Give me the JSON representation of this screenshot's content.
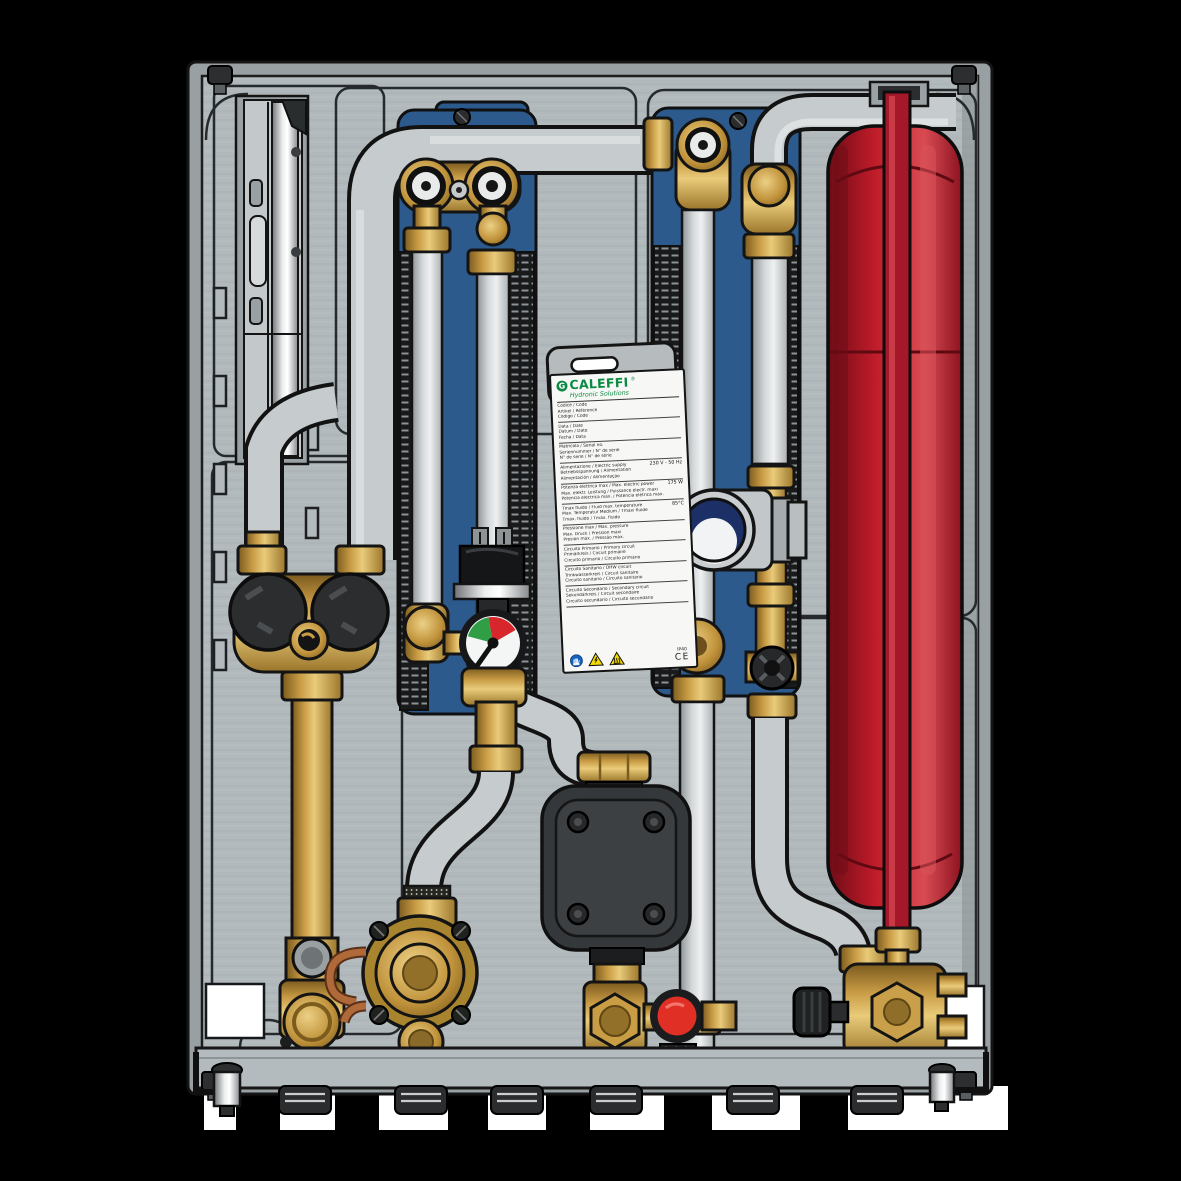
{
  "scene": {
    "background_color": "#000000",
    "description_fields_present": false
  },
  "label": {
    "brand": "CALEFFI",
    "registered_mark": "®",
    "logo_icon": "caleffi-ring-logo",
    "tagline": "Hydronic Solutions",
    "sections": [
      {
        "lines": [
          "Codice / Code",
          "Artikel / Référence",
          "Código / Code"
        ],
        "value": ""
      },
      {
        "lines": [
          "Data / Date",
          "Datum / Date",
          "Fecha / Data"
        ],
        "value": ""
      },
      {
        "lines": [
          "Matricola / Serial no.",
          "Seriennummer / N° de série",
          "N° de serie / N° de série"
        ],
        "value": ""
      },
      {
        "lines": [
          "Alimentazione / Electric supply",
          "Betriebsspannung / Alimentation",
          "Alimentación / Alimentação"
        ],
        "value": "230 V - 50 Hz"
      },
      {
        "lines": [
          "Potenza elettrica max / Max. electric power",
          "Max. elektr. Leistung / Puissance électr. maxi",
          "Potencia eléctrica máx. / Potência elétrica máx."
        ],
        "value": "175 W"
      },
      {
        "lines": [
          "Tmax fluido / Fluid max. temperature",
          "Max. Temperatur Medium / Tmaxi fluide",
          "Tmáx. fluido / Tmáx. fluido"
        ],
        "value": "85°C"
      },
      {
        "lines": [
          "Pressione max / Max. pressure",
          "Max. Druck / Pression maxi",
          "Presión máx. / Pressão máx."
        ],
        "value": ""
      },
      {
        "lines": [
          "Circuito Primario / Primary circuit",
          "Primärkreis / Circuit primaire",
          "Circuito primario / Circuito primário"
        ],
        "value": ""
      },
      {
        "lines": [
          "Circuito Sanitario / DHW circuit",
          "Trinkwasserkreis / Circuit sanitaire",
          "Circuito sanitario / Circuito sanitário"
        ],
        "value": ""
      },
      {
        "lines": [
          "Circuito Secondario / Secondary circuit",
          "Sekundärkreis / Circuit secondaire",
          "Circuito secundario / Circuito secundário"
        ],
        "value": ""
      }
    ],
    "pictograms": [
      "wear-gloves-icon",
      "electric-hazard-icon",
      "hot-surface-icon"
    ],
    "ip_rating": "IP40",
    "ce_mark": "CE"
  },
  "components": {
    "left_meter_module": "heat-meter-bracket",
    "heat_exchangers": [
      "primary-plate-heat-exchanger",
      "dhw-plate-heat-exchanger"
    ],
    "expansion_vessel": "red-expansion-vessel",
    "pump": "circulation-pump",
    "gauge": "differential-pressure-gauge",
    "thermostatic_head": "dhw-temperature-control-head",
    "valves": [
      "dual-ball-valve-black-caps",
      "diaphragm-pressure-controller",
      "fill-valve-red-knob",
      "zone-valve-black-lever"
    ],
    "bottom_connections_count": 6
  },
  "gauge": {
    "green_sector": "#2f9e44",
    "red_sector": "#d7262c",
    "face": "#f4f5f5"
  },
  "colors": {
    "hx_blue": "#2d5a8c",
    "vessel_red": "#c01c2a",
    "vessel_pipe_red": "#a5182a",
    "brand_green": "#0b8a44",
    "knob_red": "#e03026",
    "brass": "#c89b44",
    "pipe_grey": "#c6cbcd",
    "panel_grey": "#b1b9bc",
    "pump_black": "#3c4043",
    "warn_yellow": "#f2d900",
    "glove_blue": "#1565c0",
    "background": "#000000"
  }
}
